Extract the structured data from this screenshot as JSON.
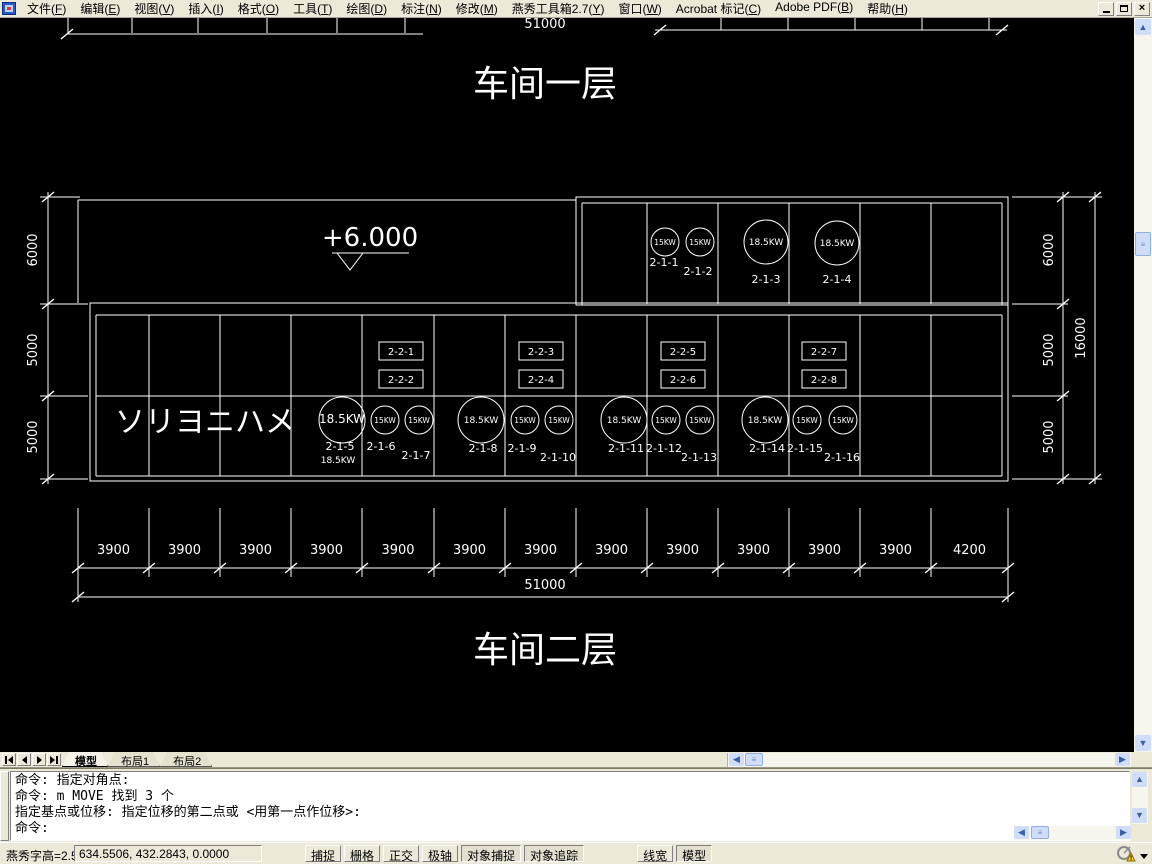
{
  "window": {
    "menu": [
      "文件(F)",
      "编辑(E)",
      "视图(V)",
      "插入(I)",
      "格式(O)",
      "工具(T)",
      "绘图(D)",
      "标注(N)",
      "修改(M)",
      "燕秀工具箱2.7(Y)",
      "窗口(W)",
      "Acrobat 标记(C)",
      "Adobe PDF(B)",
      "帮助(H)"
    ],
    "controls": [
      "minimize",
      "restore",
      "close"
    ]
  },
  "tabs": {
    "items": [
      "模型",
      "布局1",
      "布局2"
    ],
    "active": "模型"
  },
  "command": {
    "lines": [
      "命令: 指定对角点:",
      "命令: m MOVE 找到 3 个",
      "指定基点或位移: 指定位移的第二点或 <用第一点作位移>:",
      "命令:"
    ]
  },
  "status": {
    "left_text": "燕秀字高=2.5",
    "coords": "634.5506, 432.2843, 0.0000",
    "toggles": [
      {
        "label": "捕捉",
        "pressed": false
      },
      {
        "label": "栅格",
        "pressed": false
      },
      {
        "label": "正交",
        "pressed": false
      },
      {
        "label": "极轴",
        "pressed": false
      },
      {
        "label": "对象捕捉",
        "pressed": true
      },
      {
        "label": "对象追踪",
        "pressed": true
      },
      {
        "label": "线宽",
        "pressed": false,
        "gap_before": true
      },
      {
        "label": "模型",
        "pressed": true
      }
    ]
  },
  "chart_data": {
    "type": "floor-plan",
    "floor_title_top": "车间一层",
    "floor_title_bottom": "车间二层",
    "elevation_marker": "+6.000",
    "note_text": "ソリヨニハメ",
    "top_total_dim": "51000",
    "bottom_total_dim": "51000",
    "bay_dims": [
      "3900",
      "3900",
      "3900",
      "3900",
      "3900",
      "3900",
      "3900",
      "3900",
      "3900",
      "3900",
      "3900",
      "3900",
      "4200"
    ],
    "left_row_dims": [
      "6000",
      "5000",
      "5000"
    ],
    "right_row_dims": [
      "6000",
      "5000",
      "5000"
    ],
    "right_total_dim": "16000",
    "equipment_circles": [
      {
        "tag": "2-1-1",
        "power": "15KW",
        "cx": 665,
        "cy": 242,
        "r": 14,
        "tx": 664,
        "ty": 266
      },
      {
        "tag": "2-1-2",
        "power": "15KW",
        "cx": 700,
        "cy": 242,
        "r": 14,
        "tx": 698,
        "ty": 275
      },
      {
        "tag": "2-1-3",
        "power": "18.5KW",
        "cx": 766,
        "cy": 242,
        "r": 22,
        "tx": 766,
        "ty": 283
      },
      {
        "tag": "2-1-4",
        "power": "18.5KW",
        "cx": 837,
        "cy": 243,
        "r": 22,
        "tx": 837,
        "ty": 283
      },
      {
        "tag": "2-1-5",
        "power": "18.5KW",
        "cx": 342,
        "cy": 420,
        "r": 23,
        "tx": 340,
        "ty": 450,
        "big_label": true,
        "sub": "18.5KW",
        "sx": 338,
        "sy": 463
      },
      {
        "tag": "2-1-6",
        "power": "15KW",
        "cx": 385,
        "cy": 420,
        "r": 14,
        "tx": 381,
        "ty": 450
      },
      {
        "tag": "2-1-7",
        "power": "15KW",
        "cx": 419,
        "cy": 420,
        "r": 14,
        "tx": 416,
        "ty": 459
      },
      {
        "tag": "2-1-8",
        "power": "18.5KW",
        "cx": 481,
        "cy": 420,
        "r": 23,
        "tx": 483,
        "ty": 452
      },
      {
        "tag": "2-1-9",
        "power": "15KW",
        "cx": 525,
        "cy": 420,
        "r": 14,
        "tx": 522,
        "ty": 452
      },
      {
        "tag": "2-1-10",
        "power": "15KW",
        "cx": 559,
        "cy": 420,
        "r": 14,
        "tx": 558,
        "ty": 461
      },
      {
        "tag": "2-1-11",
        "power": "18.5KW",
        "cx": 624,
        "cy": 420,
        "r": 23,
        "tx": 626,
        "ty": 452
      },
      {
        "tag": "2-1-12",
        "power": "15KW",
        "cx": 666,
        "cy": 420,
        "r": 14,
        "tx": 664,
        "ty": 452
      },
      {
        "tag": "2-1-13",
        "power": "15KW",
        "cx": 700,
        "cy": 420,
        "r": 14,
        "tx": 699,
        "ty": 461
      },
      {
        "tag": "2-1-14",
        "power": "18.5KW",
        "cx": 765,
        "cy": 420,
        "r": 23,
        "tx": 767,
        "ty": 452
      },
      {
        "tag": "2-1-15",
        "power": "15KW",
        "cx": 807,
        "cy": 420,
        "r": 14,
        "tx": 805,
        "ty": 452
      },
      {
        "tag": "2-1-16",
        "power": "15KW",
        "cx": 843,
        "cy": 420,
        "r": 14,
        "tx": 842,
        "ty": 461
      }
    ],
    "equipment_boxes": [
      {
        "tag": "2-2-1",
        "x": 379,
        "y": 342
      },
      {
        "tag": "2-2-2",
        "x": 379,
        "y": 370
      },
      {
        "tag": "2-2-3",
        "x": 519,
        "y": 342
      },
      {
        "tag": "2-2-4",
        "x": 519,
        "y": 370
      },
      {
        "tag": "2-2-5",
        "x": 661,
        "y": 342
      },
      {
        "tag": "2-2-6",
        "x": 661,
        "y": 370
      },
      {
        "tag": "2-2-7",
        "x": 802,
        "y": 342
      },
      {
        "tag": "2-2-8",
        "x": 802,
        "y": 370
      }
    ]
  }
}
